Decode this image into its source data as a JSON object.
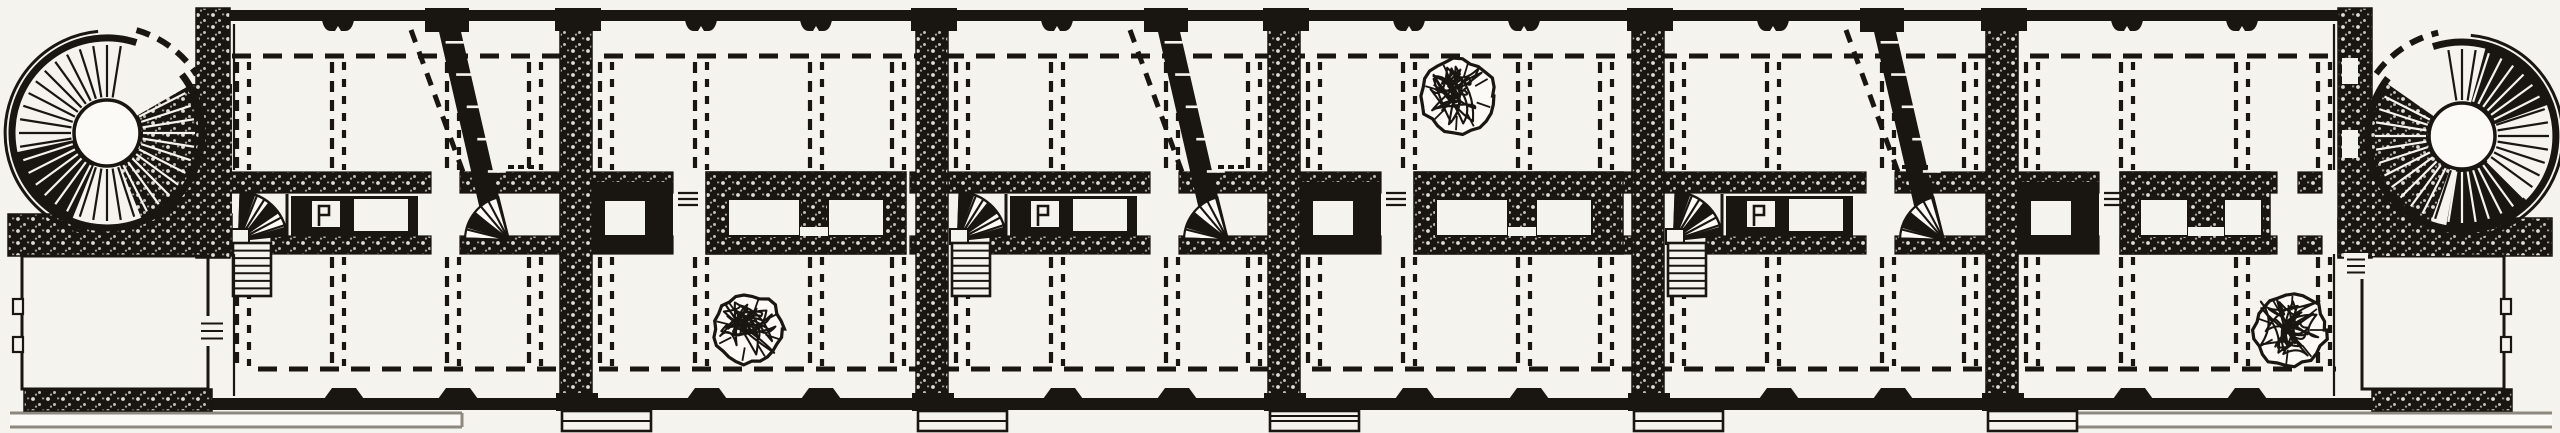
{
  "figure": {
    "title": "Engraved floor plan — long gallery wing with circular corner stair towers",
    "description": "Black-and-white engraved architectural floor plan: six vaulted bays along a spine corridor, rubble-textured cross walls, circular spiral-stair towers at both ends, diagonal stair flights, winder stairs, dashed beam lines and three scribbled ceiling roses.",
    "width": 2560,
    "height": 433
  },
  "palette": {
    "paper": "#f5f3ee",
    "paper_bright": "#fbfaf6",
    "ink": "#191510",
    "ink_soft": "#2c2822",
    "gray_line": "#8d897f",
    "speckle_gray": "#cfccc4"
  },
  "plan": {
    "levels": {
      "top_wall_y": 10,
      "top_wall_h": 11,
      "top_dash_y": 56,
      "upper_band_y": 172,
      "upper_band_h": 21,
      "lower_band_y": 236,
      "lower_band_h": 18,
      "bottom_dash_y": 369,
      "bottom_wall_y": 398,
      "bottom_wall_h": 12,
      "terrace_y1": 413,
      "terrace_y2": 427,
      "dash_col_upper": [
        62,
        170
      ],
      "dash_col_lower": [
        257,
        366
      ]
    },
    "facade_span": [
      196,
      2372
    ],
    "dash_span": [
      232,
      2336
    ],
    "cross_walls": [
      576,
      932,
      1284,
      1648,
      2002
    ],
    "wall_half_width": 16,
    "pavilion_walls": {
      "left": [
        196,
        230
      ],
      "right": [
        2338,
        2372
      ]
    },
    "bays": [
      {
        "x0": 213,
        "x1": 576,
        "type": "stair"
      },
      {
        "x0": 576,
        "x1": 932,
        "type": "frames",
        "rosette": {
          "cx": 748,
          "cy": 329,
          "r": 34
        },
        "frame_c": [
          130,
          330
        ],
        "gaps": [
          [
            97,
            130
          ],
          [
            312,
            334
          ]
        ]
      },
      {
        "x0": 932,
        "x1": 1284,
        "type": "stair"
      },
      {
        "x0": 1284,
        "x1": 1648,
        "type": "frames",
        "rosette": {
          "cx": 1458,
          "cy": 96,
          "r": 36
        },
        "frame_c": [
          130,
          339
        ],
        "gaps": [
          [
            97,
            130
          ],
          [
            312,
            334
          ]
        ]
      },
      {
        "x0": 1648,
        "x1": 2002,
        "type": "stair"
      },
      {
        "x0": 2002,
        "x1": 2338,
        "type": "frames",
        "rosette": {
          "cx": 2290,
          "cy": 330,
          "r": 36
        },
        "frame_c": [
          118,
          268
        ],
        "gaps": [
          [
            97,
            118
          ],
          [
            275,
            296
          ]
        ],
        "frame_c_openings": [
          [
            138,
            186
          ],
          [
            222,
            260
          ]
        ]
      }
    ],
    "dash_pair_offsets": [
      30,
      125,
      240,
      322
    ],
    "facade_dip_offsets": [
      127,
      242
    ],
    "bottom_bump_offsets": [
      131,
      245
    ],
    "stair_unit": {
      "fan_hub": [
        26,
        240
      ],
      "fan_r": 48,
      "fan_angles": [
        -88,
        -6
      ],
      "flight": [
        20,
        243,
        38,
        53
      ],
      "frame_a": [
        78,
        205
      ],
      "a_opening1": [
        98,
        128
      ],
      "a_opening2": [
        140,
        196
      ],
      "gap": [
        218,
        247
      ],
      "diag_poly": [
        221,
        243,
        295,
        273
      ],
      "diag_top_block": [
        212,
        44
      ],
      "dashed_diag": [
        198,
        30,
        250,
        172
      ],
      "foot_fan_hub": [
        296,
        240
      ],
      "foot_fan_r": 44,
      "foot_fan_angles": [
        182,
        256
      ]
    },
    "frame_unit": {
      "frame_b": [
        12,
        97
      ],
      "b_opening": [
        28,
        70
      ],
      "c_openings": [
        [
          152,
          224
        ],
        [
          252,
          308
        ]
      ],
      "step_glyph": [
        102,
        122
      ]
    },
    "towers": {
      "left": {
        "cx": 107,
        "cy": 133,
        "r_outer": 95,
        "r_inner": 33,
        "door_arc": [
          -72,
          -38
        ],
        "dark_sectors": [
          [
            -30,
            68
          ],
          [
            112,
            168
          ]
        ],
        "rim_arc": [
          95,
          265
        ],
        "mass": [
          160,
          84,
          72,
          152
        ]
      },
      "right": {
        "cx": 2462,
        "cy": 136,
        "r_outer": 94,
        "r_inner": 33,
        "door_arc": [
          -142,
          -108
        ],
        "dark_sectors": [
          [
            110,
            215
          ],
          [
            -75,
            -20
          ],
          [
            45,
            100
          ]
        ],
        "rim_arc": [
          -85,
          85
        ],
        "mass": [
          2372,
          100,
          80,
          156
        ]
      }
    },
    "pavilions": {
      "left": {
        "band": [
          8,
          214,
          224,
          42
        ],
        "bottom_band": [
          24,
          389,
          188,
          22
        ],
        "wall": [
          196,
          8,
          34,
          250
        ],
        "face_line_x": 234,
        "room": [
          22,
          256,
          186,
          133
        ],
        "bumps_x": 13,
        "bumps_y": [
          299,
          337
        ],
        "door": [
          198,
          316,
          28,
          30
        ],
        "terrace": [
          10,
          462
        ]
      },
      "right": {
        "band": [
          2338,
          218,
          214,
          38
        ],
        "bottom_band": [
          2372,
          389,
          140,
          22
        ],
        "wall": [
          2338,
          8,
          34,
          250
        ],
        "face_line_x": 2334,
        "room": [
          2362,
          256,
          142,
          133
        ],
        "bumps_x": 2501,
        "bumps_y": [
          299,
          337
        ],
        "door": [
          2344,
          253,
          24,
          26
        ],
        "terrace": [
          2066,
          2552
        ],
        "wall_slots": [
          [
            2342,
            58,
            16,
            26
          ],
          [
            2342,
            130,
            16,
            28
          ]
        ]
      }
    },
    "porch": {
      "dx": -14,
      "y": 411,
      "w": 89,
      "h": 20
    },
    "label_marks": [
      508,
      1218,
      1902
    ],
    "rosette_seed": 7
  }
}
